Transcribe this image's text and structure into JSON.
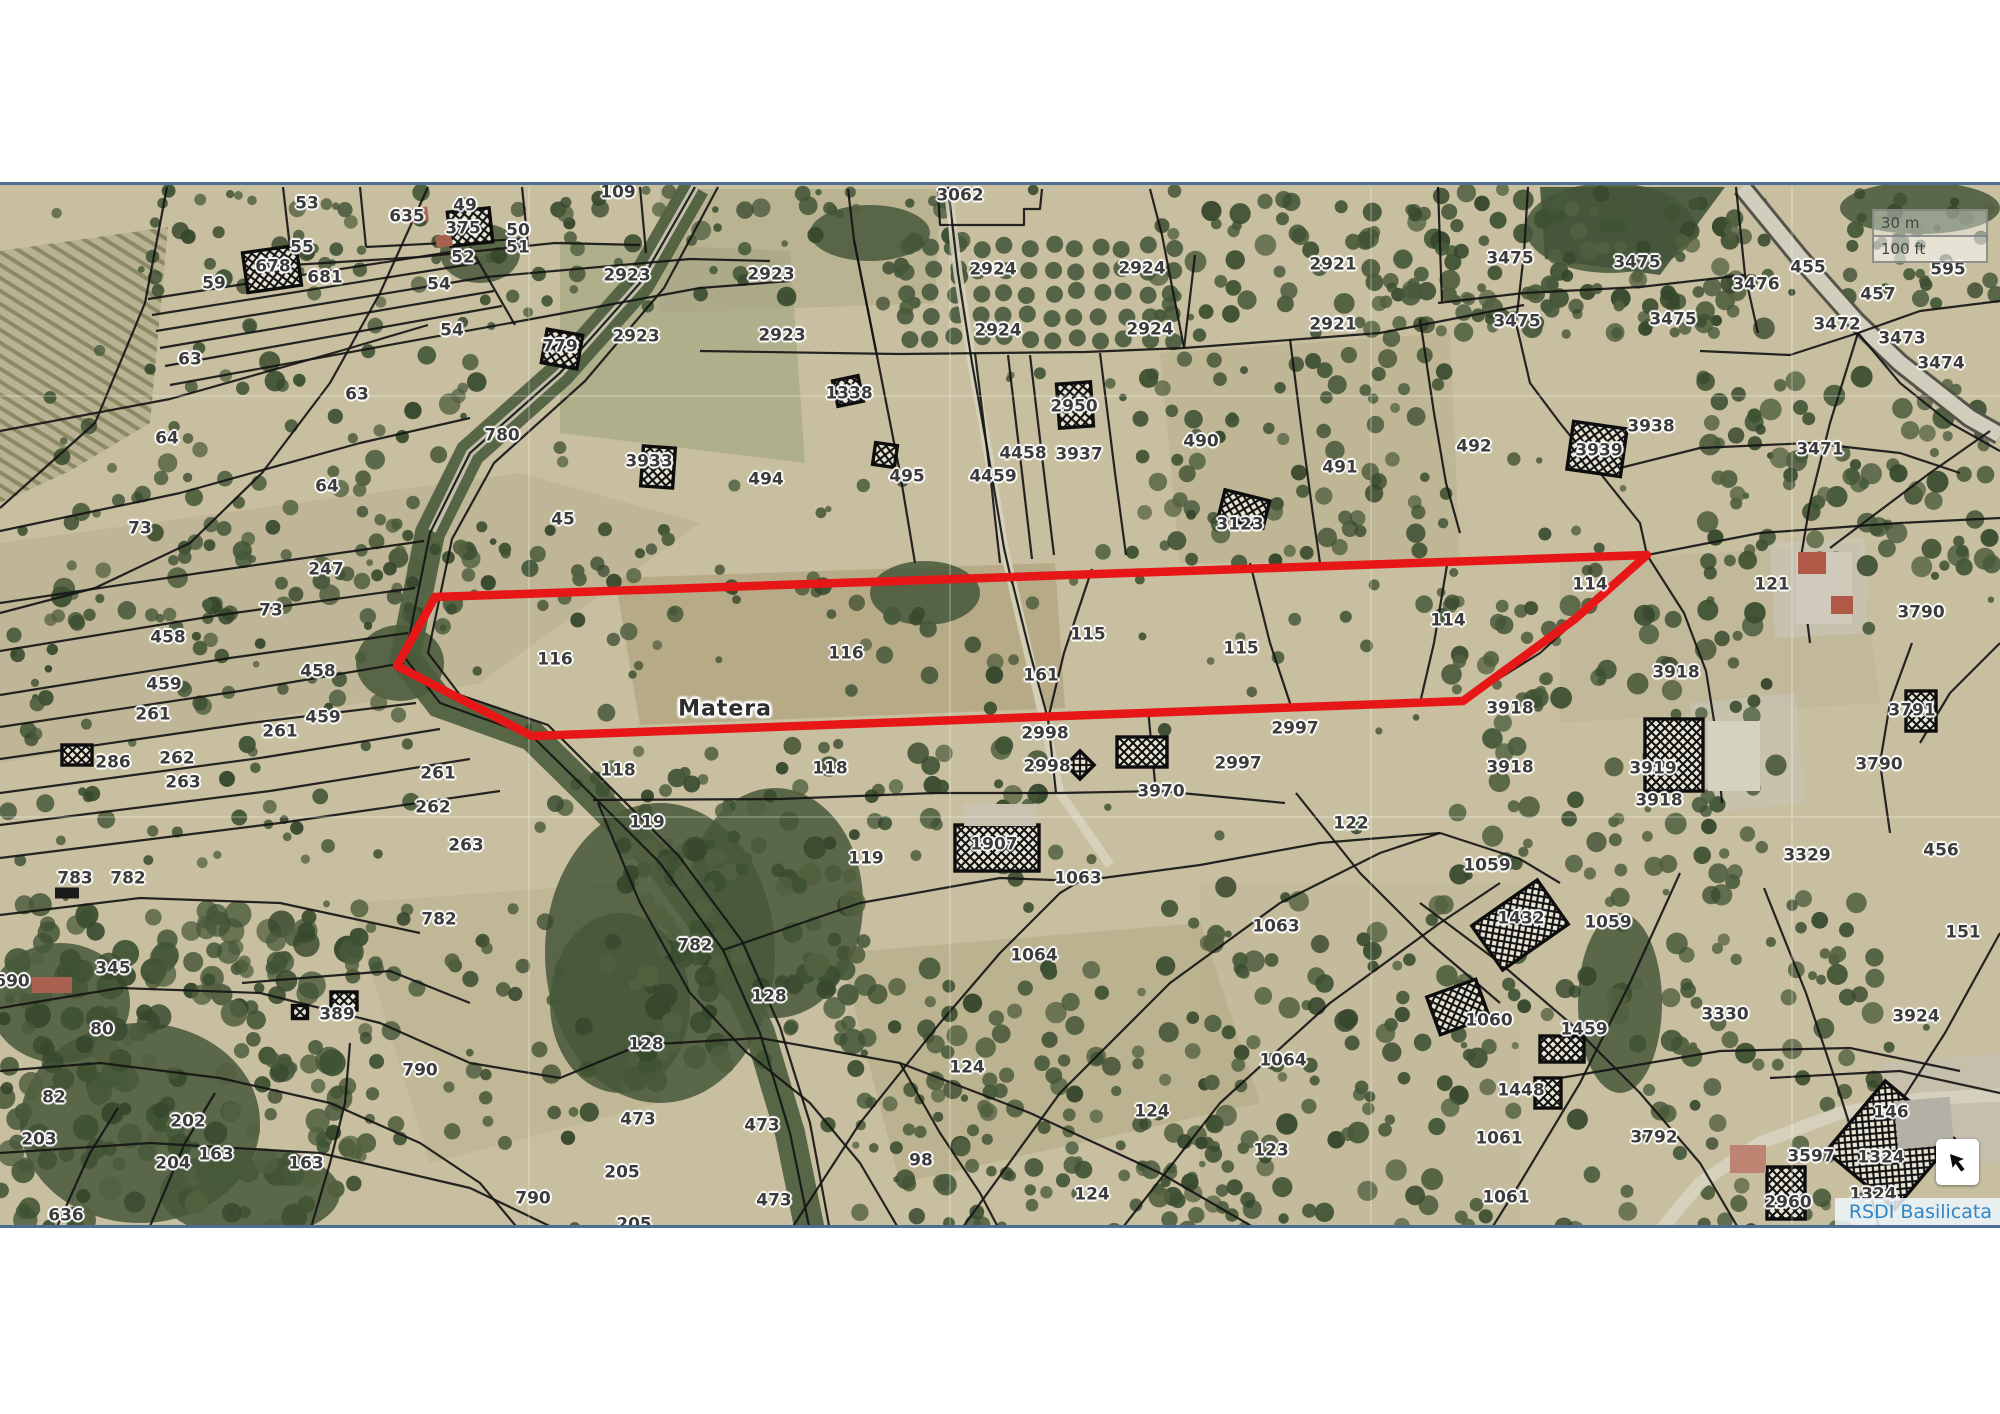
{
  "map": {
    "place_label": "Matera",
    "place_pos": {
      "x": 725,
      "y": 706
    },
    "attribution": "RSDI Basilicata",
    "scalebar": {
      "metric": "30 m",
      "imperial": "100 ft"
    },
    "colors": {
      "highlight_red": "#e81717",
      "attribution_blue": "#2e86c8",
      "frame_blue": "#4d6e90",
      "terrain_base": "#c7bf9f"
    },
    "controls": {
      "nav_button_icon": "arrow-up-left-icon"
    },
    "highlight_polygon": [
      [
        435,
        594
      ],
      [
        1647,
        552
      ],
      [
        1575,
        616
      ],
      [
        1463,
        698
      ],
      [
        532,
        733
      ],
      [
        397,
        663
      ]
    ],
    "labels": [
      {
        "t": "109",
        "x": 618,
        "y": 190
      },
      {
        "t": "53",
        "x": 307,
        "y": 201
      },
      {
        "t": "49",
        "x": 465,
        "y": 203
      },
      {
        "t": "635",
        "x": 407,
        "y": 214
      },
      {
        "t": "375",
        "x": 463,
        "y": 226
      },
      {
        "t": "50",
        "x": 518,
        "y": 228
      },
      {
        "t": "51",
        "x": 518,
        "y": 245
      },
      {
        "t": "55",
        "x": 302,
        "y": 245
      },
      {
        "t": "52",
        "x": 463,
        "y": 255
      },
      {
        "t": "678",
        "x": 273,
        "y": 264
      },
      {
        "t": "681",
        "x": 325,
        "y": 275
      },
      {
        "t": "59",
        "x": 214,
        "y": 281
      },
      {
        "t": "54",
        "x": 439,
        "y": 282
      },
      {
        "t": "54",
        "x": 452,
        "y": 328
      },
      {
        "t": "3062",
        "x": 960,
        "y": 193
      },
      {
        "t": "2923",
        "x": 627,
        "y": 273
      },
      {
        "t": "2923",
        "x": 636,
        "y": 334
      },
      {
        "t": "2923",
        "x": 771,
        "y": 272
      },
      {
        "t": "2923",
        "x": 782,
        "y": 333
      },
      {
        "t": "2924",
        "x": 993,
        "y": 267
      },
      {
        "t": "2924",
        "x": 1142,
        "y": 266
      },
      {
        "t": "2924",
        "x": 998,
        "y": 328
      },
      {
        "t": "2924",
        "x": 1150,
        "y": 327
      },
      {
        "t": "2921",
        "x": 1333,
        "y": 262
      },
      {
        "t": "2921",
        "x": 1333,
        "y": 322
      },
      {
        "t": "3475",
        "x": 1510,
        "y": 256
      },
      {
        "t": "3475",
        "x": 1637,
        "y": 260
      },
      {
        "t": "3475",
        "x": 1517,
        "y": 319
      },
      {
        "t": "3475",
        "x": 1673,
        "y": 317
      },
      {
        "t": "3476",
        "x": 1756,
        "y": 282
      },
      {
        "t": "455",
        "x": 1808,
        "y": 265
      },
      {
        "t": "457",
        "x": 1878,
        "y": 292
      },
      {
        "t": "595",
        "x": 1948,
        "y": 267
      },
      {
        "t": "3472",
        "x": 1837,
        "y": 322
      },
      {
        "t": "3473",
        "x": 1902,
        "y": 336
      },
      {
        "t": "3474",
        "x": 1941,
        "y": 361
      },
      {
        "t": "63",
        "x": 190,
        "y": 357
      },
      {
        "t": "63",
        "x": 357,
        "y": 392
      },
      {
        "t": "779",
        "x": 560,
        "y": 344
      },
      {
        "t": "1338",
        "x": 849,
        "y": 391
      },
      {
        "t": "2950",
        "x": 1074,
        "y": 404
      },
      {
        "t": "3937",
        "x": 1079,
        "y": 452
      },
      {
        "t": "4458",
        "x": 1023,
        "y": 451
      },
      {
        "t": "4459",
        "x": 993,
        "y": 474
      },
      {
        "t": "495",
        "x": 907,
        "y": 474
      },
      {
        "t": "494",
        "x": 766,
        "y": 477
      },
      {
        "t": "490",
        "x": 1201,
        "y": 439
      },
      {
        "t": "491",
        "x": 1340,
        "y": 465
      },
      {
        "t": "492",
        "x": 1474,
        "y": 444
      },
      {
        "t": "3938",
        "x": 1651,
        "y": 424
      },
      {
        "t": "3939",
        "x": 1599,
        "y": 448
      },
      {
        "t": "3471",
        "x": 1820,
        "y": 447
      },
      {
        "t": "3123",
        "x": 1240,
        "y": 522
      },
      {
        "t": "3933",
        "x": 649,
        "y": 459
      },
      {
        "t": "45",
        "x": 563,
        "y": 517
      },
      {
        "t": "780",
        "x": 502,
        "y": 433
      },
      {
        "t": "64",
        "x": 167,
        "y": 436
      },
      {
        "t": "64",
        "x": 327,
        "y": 484
      },
      {
        "t": "73",
        "x": 140,
        "y": 526
      },
      {
        "t": "121",
        "x": 1772,
        "y": 582
      },
      {
        "t": "3790",
        "x": 1921,
        "y": 610
      },
      {
        "t": "114",
        "x": 1590,
        "y": 582
      },
      {
        "t": "114",
        "x": 1448,
        "y": 618
      },
      {
        "t": "247",
        "x": 326,
        "y": 567
      },
      {
        "t": "73",
        "x": 271,
        "y": 608
      },
      {
        "t": "458",
        "x": 168,
        "y": 635
      },
      {
        "t": "458",
        "x": 318,
        "y": 669
      },
      {
        "t": "459",
        "x": 164,
        "y": 682
      },
      {
        "t": "459",
        "x": 323,
        "y": 715
      },
      {
        "t": "261",
        "x": 153,
        "y": 712
      },
      {
        "t": "261",
        "x": 280,
        "y": 729
      },
      {
        "t": "286",
        "x": 113,
        "y": 760
      },
      {
        "t": "262",
        "x": 177,
        "y": 756
      },
      {
        "t": "263",
        "x": 183,
        "y": 780
      },
      {
        "t": "261",
        "x": 438,
        "y": 771
      },
      {
        "t": "262",
        "x": 433,
        "y": 805
      },
      {
        "t": "263",
        "x": 466,
        "y": 843
      },
      {
        "t": "116",
        "x": 555,
        "y": 657
      },
      {
        "t": "116",
        "x": 846,
        "y": 651
      },
      {
        "t": "115",
        "x": 1088,
        "y": 632
      },
      {
        "t": "161",
        "x": 1041,
        "y": 673
      },
      {
        "t": "115",
        "x": 1241,
        "y": 646
      },
      {
        "t": "3918",
        "x": 1676,
        "y": 670
      },
      {
        "t": "3918",
        "x": 1510,
        "y": 706
      },
      {
        "t": "3791",
        "x": 1912,
        "y": 708
      },
      {
        "t": "2998",
        "x": 1045,
        "y": 731
      },
      {
        "t": "2998",
        "x": 1047,
        "y": 764
      },
      {
        "t": "2997",
        "x": 1295,
        "y": 726
      },
      {
        "t": "2997",
        "x": 1238,
        "y": 761
      },
      {
        "t": "3970",
        "x": 1161,
        "y": 789
      },
      {
        "t": "118",
        "x": 618,
        "y": 768
      },
      {
        "t": "118",
        "x": 830,
        "y": 766
      },
      {
        "t": "119",
        "x": 647,
        "y": 820
      },
      {
        "t": "119",
        "x": 866,
        "y": 856
      },
      {
        "t": "3918",
        "x": 1510,
        "y": 765
      },
      {
        "t": "3919",
        "x": 1653,
        "y": 766
      },
      {
        "t": "3918",
        "x": 1659,
        "y": 798
      },
      {
        "t": "3790",
        "x": 1879,
        "y": 762
      },
      {
        "t": "122",
        "x": 1351,
        "y": 821
      },
      {
        "t": "1059",
        "x": 1487,
        "y": 863
      },
      {
        "t": "3329",
        "x": 1807,
        "y": 853
      },
      {
        "t": "456",
        "x": 1941,
        "y": 848
      },
      {
        "t": "783",
        "x": 75,
        "y": 876
      },
      {
        "t": "782",
        "x": 128,
        "y": 876
      },
      {
        "t": "782",
        "x": 439,
        "y": 917
      },
      {
        "t": "782",
        "x": 695,
        "y": 943
      },
      {
        "t": "1907",
        "x": 994,
        "y": 842
      },
      {
        "t": "1063",
        "x": 1078,
        "y": 876
      },
      {
        "t": "1063",
        "x": 1276,
        "y": 924
      },
      {
        "t": "345",
        "x": 113,
        "y": 966
      },
      {
        "t": "690",
        "x": 12,
        "y": 979
      },
      {
        "t": "80",
        "x": 102,
        "y": 1027
      },
      {
        "t": "389",
        "x": 337,
        "y": 1012
      },
      {
        "t": "790",
        "x": 420,
        "y": 1068
      },
      {
        "t": "82",
        "x": 54,
        "y": 1095
      },
      {
        "t": "202",
        "x": 188,
        "y": 1119
      },
      {
        "t": "203",
        "x": 39,
        "y": 1137
      },
      {
        "t": "204",
        "x": 173,
        "y": 1161
      },
      {
        "t": "163",
        "x": 216,
        "y": 1152
      },
      {
        "t": "163",
        "x": 306,
        "y": 1161
      },
      {
        "t": "636",
        "x": 66,
        "y": 1213
      },
      {
        "t": "128",
        "x": 646,
        "y": 1042
      },
      {
        "t": "473",
        "x": 638,
        "y": 1117
      },
      {
        "t": "205",
        "x": 622,
        "y": 1170
      },
      {
        "t": "790",
        "x": 533,
        "y": 1196
      },
      {
        "t": "205",
        "x": 634,
        "y": 1222
      },
      {
        "t": "128",
        "x": 769,
        "y": 994
      },
      {
        "t": "1064",
        "x": 1034,
        "y": 953
      },
      {
        "t": "1064",
        "x": 1283,
        "y": 1058
      },
      {
        "t": "124",
        "x": 967,
        "y": 1065
      },
      {
        "t": "124",
        "x": 1152,
        "y": 1109
      },
      {
        "t": "124",
        "x": 1092,
        "y": 1192
      },
      {
        "t": "123",
        "x": 1271,
        "y": 1148
      },
      {
        "t": "473",
        "x": 762,
        "y": 1123
      },
      {
        "t": "473",
        "x": 774,
        "y": 1198
      },
      {
        "t": "98",
        "x": 921,
        "y": 1158
      },
      {
        "t": "1432",
        "x": 1521,
        "y": 916
      },
      {
        "t": "1059",
        "x": 1608,
        "y": 920
      },
      {
        "t": "151",
        "x": 1963,
        "y": 930
      },
      {
        "t": "1060",
        "x": 1489,
        "y": 1018
      },
      {
        "t": "1459",
        "x": 1584,
        "y": 1027
      },
      {
        "t": "3330",
        "x": 1725,
        "y": 1012
      },
      {
        "t": "3924",
        "x": 1916,
        "y": 1014
      },
      {
        "t": "1448",
        "x": 1521,
        "y": 1088
      },
      {
        "t": "1061",
        "x": 1499,
        "y": 1136
      },
      {
        "t": "1061",
        "x": 1506,
        "y": 1195
      },
      {
        "t": "3792",
        "x": 1654,
        "y": 1135
      },
      {
        "t": "146",
        "x": 1891,
        "y": 1110
      },
      {
        "t": "3597",
        "x": 1811,
        "y": 1154
      },
      {
        "t": "1324",
        "x": 1881,
        "y": 1155
      },
      {
        "t": "1324",
        "x": 1873,
        "y": 1192
      },
      {
        "t": "2960",
        "x": 1788,
        "y": 1200
      }
    ]
  }
}
